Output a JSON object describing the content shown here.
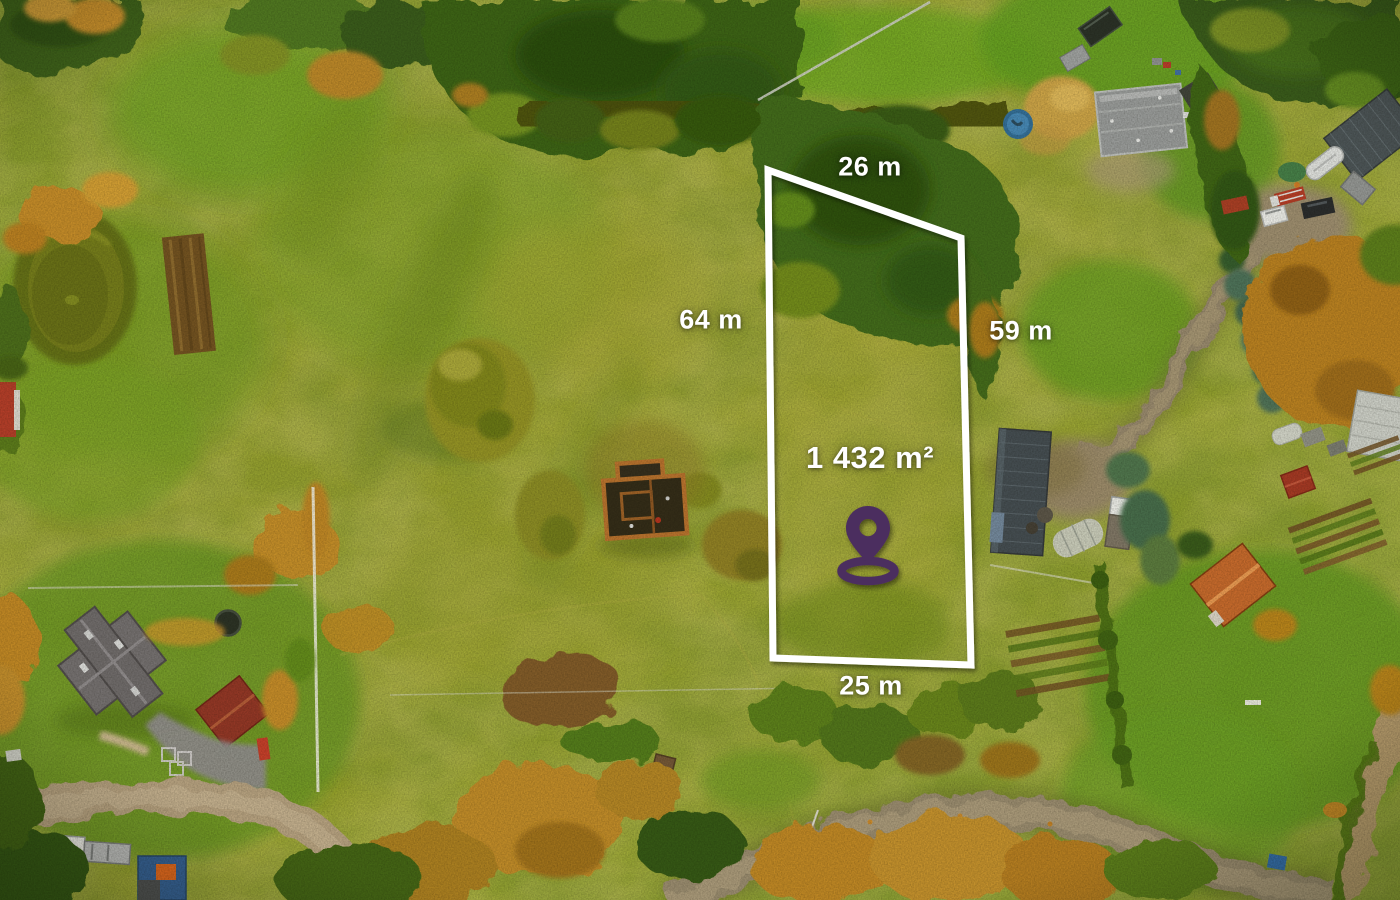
{
  "page": {
    "type": "real-estate aerial drone photograph",
    "description": "Autumn aerial view of grassy parcels with houses, a pond, a ruined building, gravel roads and forest; a building plot is outlined in white with dimensions, area and a purple location pin."
  },
  "annotation": {
    "side_top_label": "26 m",
    "side_left_label": "64 m",
    "side_right_label": "59 m",
    "side_bottom_label": "25 m",
    "area_label": "1 432 m²",
    "boundary_color": "#ffffff",
    "label_text_color": "#ffffff",
    "pin_icon": "location-pin-icon",
    "pin_color": "#4b2d5e"
  }
}
